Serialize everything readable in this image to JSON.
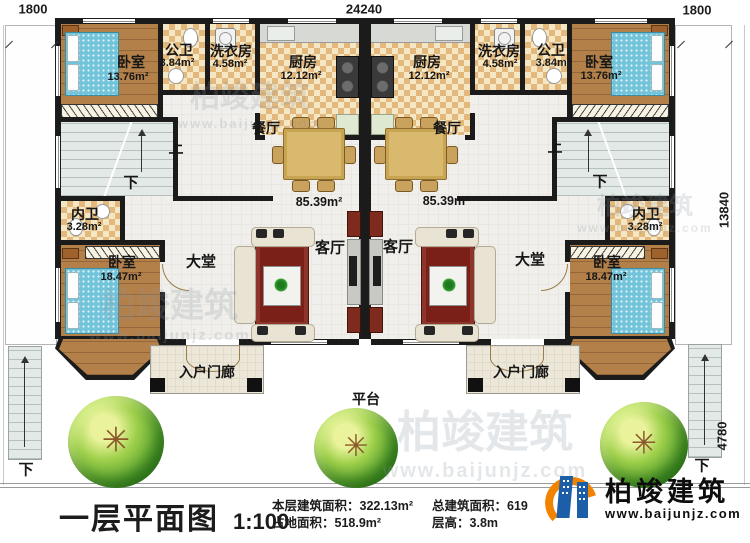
{
  "dimensions": {
    "top_left": "1800",
    "top_center": "24240",
    "top_right": "1800",
    "right_upper": "13840",
    "right_lower": "4780"
  },
  "units": {
    "left": {
      "bedroom_top": {
        "name": "卧室",
        "area": "13.76m²"
      },
      "bath_public": {
        "name": "公卫",
        "area": "3.84m²"
      },
      "laundry": {
        "name": "洗衣房",
        "area": "4.58m²"
      },
      "kitchen": {
        "name": "厨房",
        "area": "12.12m²"
      },
      "dining": "餐厅",
      "up": "上",
      "down": "下",
      "open_area": "85.39m²",
      "bath_inner": {
        "name": "内卫",
        "area": "3.28m²"
      },
      "bedroom_main": {
        "name": "卧室",
        "area": "18.47m²"
      },
      "hall": "大堂",
      "living": "客厅",
      "porch": "入户门廊"
    },
    "right": {
      "bedroom_top": {
        "name": "卧室",
        "area": "13.76m²"
      },
      "bath_public": {
        "name": "公卫",
        "area": "3.84m²"
      },
      "laundry": {
        "name": "洗衣房",
        "area": "4.58m²"
      },
      "kitchen": {
        "name": "厨房",
        "area": "12.12m²"
      },
      "dining": "餐厅",
      "up": "上",
      "down": "下",
      "open_area": "85.39m²",
      "bath_inner": {
        "name": "内卫",
        "area": "3.28m²"
      },
      "bedroom_main": {
        "name": "卧室",
        "area": "18.47m²"
      },
      "hall": "大堂",
      "living": "客厅",
      "porch": "入户门廊"
    }
  },
  "site": {
    "platform": "平台",
    "down_left": "下",
    "down_right": "下"
  },
  "titleblock": {
    "title": "一层平面图",
    "scale": "1:100",
    "stats": [
      {
        "label": "本层建筑面积：",
        "value": "322.13m²"
      },
      {
        "label": "占地面积：",
        "value": "518.9m²"
      },
      {
        "label": "总建筑面积：",
        "value": "619"
      },
      {
        "label": "层高：",
        "value": "3.8m"
      }
    ]
  },
  "logo": {
    "name": "柏竣建筑",
    "url": "www.baijunjz.com"
  },
  "watermark": {
    "name": "柏竣建筑",
    "url": "www.baijunjz.com"
  }
}
